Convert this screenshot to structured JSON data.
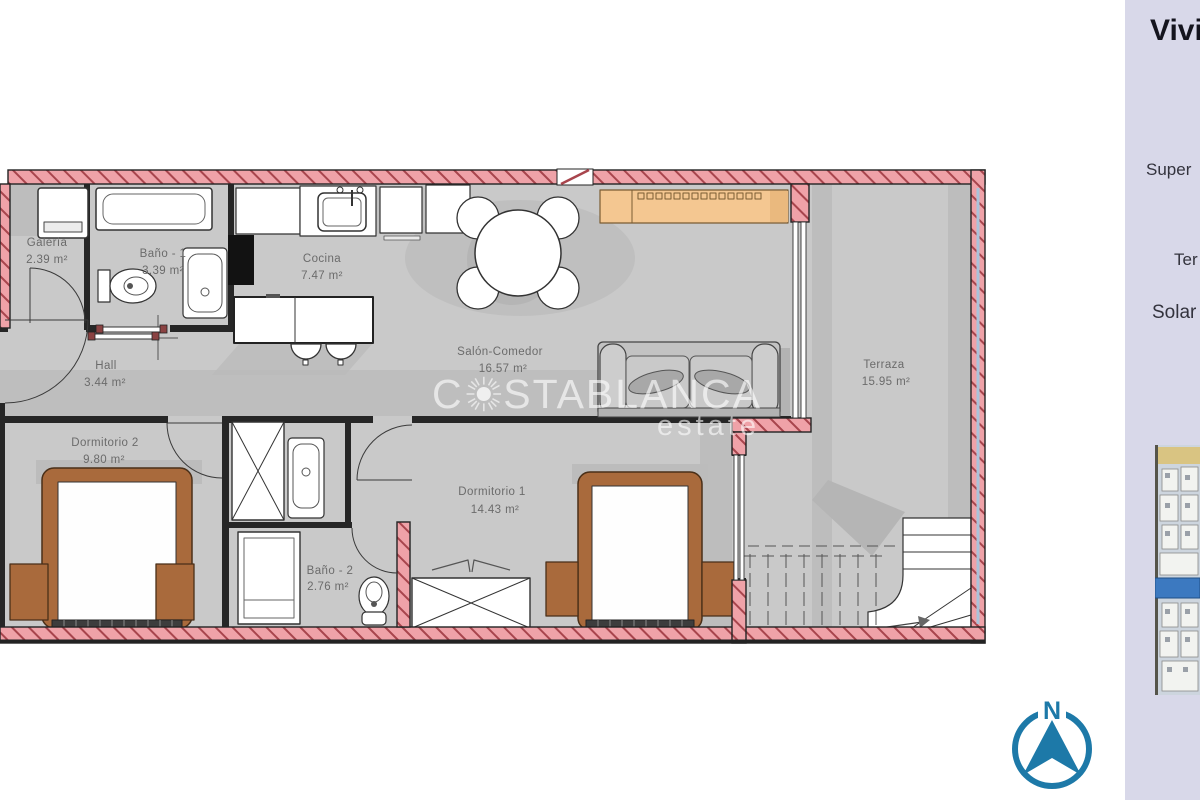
{
  "plan": {
    "rooms": [
      {
        "id": "galeria",
        "name": "Galería",
        "area": "2.39 m²"
      },
      {
        "id": "bano1",
        "name": "Baño - 1",
        "area": "3.39 m²"
      },
      {
        "id": "cocina",
        "name": "Cocina",
        "area": "7.47 m²"
      },
      {
        "id": "salon",
        "name": "Salón-Comedor",
        "area": "16.57 m²"
      },
      {
        "id": "hall",
        "name": "Hall",
        "area": "3.44 m²"
      },
      {
        "id": "dormitorio2",
        "name": "Dormitorio 2",
        "area": "9.80 m²"
      },
      {
        "id": "dormitorio1",
        "name": "Dormitorio 1",
        "area": "14.43 m²"
      },
      {
        "id": "bano2",
        "name": "Baño - 2",
        "area": "2.76 m²"
      },
      {
        "id": "terraza",
        "name": "Terraza",
        "area": "15.95 m²"
      }
    ]
  },
  "watermark": {
    "part1": "C",
    "part2": "STABLANCA",
    "subtitle": "estate"
  },
  "side_panel": {
    "title": "Vivi",
    "row1": "Super",
    "row2": "Ter",
    "row3": "Solar"
  },
  "compass": {
    "north_label": "N"
  },
  "colors": {
    "wall_pink": "#efa2a8",
    "wall_hatch": "#a8454d",
    "floor": "#c9c9c9",
    "floor_shadow": "#b9b9b9",
    "panel_bg": "#d8d8e9",
    "accent_blue": "#1d79a8",
    "sideboard": "#f4c791",
    "wood": "#a96a3c",
    "thumb_blue": "#3c79c0",
    "glass_blue": "#a9c3da"
  }
}
